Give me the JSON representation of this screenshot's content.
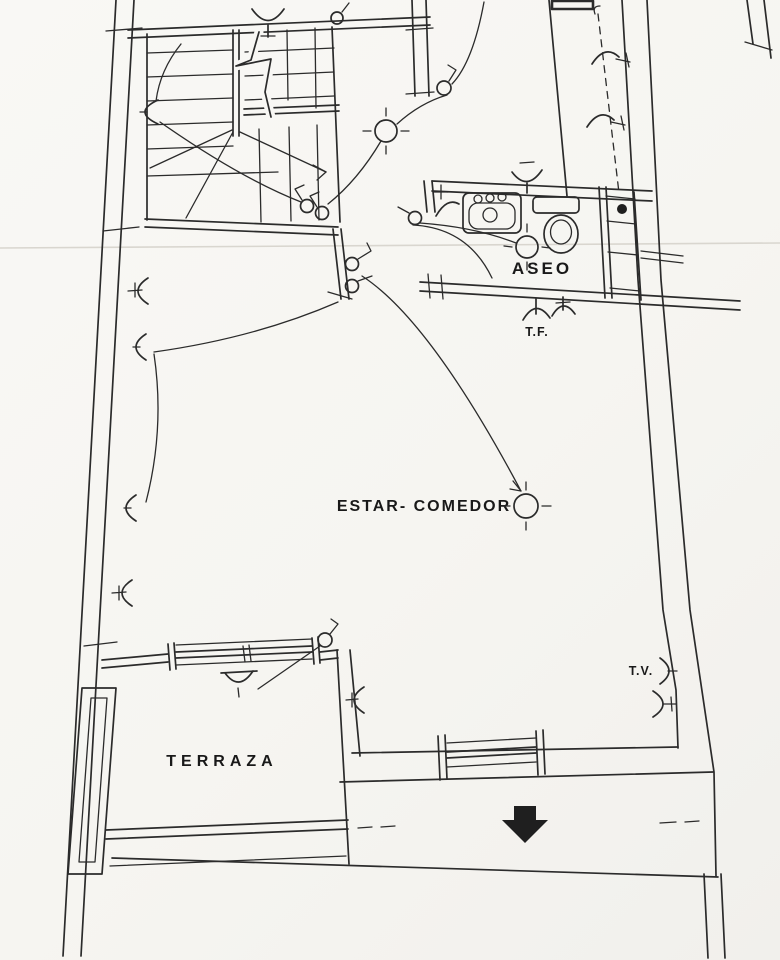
{
  "document": {
    "kind": "scanned architectural floor plan with electrical installation symbols",
    "language": "Spanish"
  },
  "labels": {
    "aseo": "ASEO",
    "estar_comedor": "ESTAR- COMEDOR",
    "terraza": "TERRAZA",
    "tf": "T.F.",
    "tv": "T.V."
  },
  "symbols": {
    "ceiling_light_icon": "circle with four radial ticks",
    "wall_light_icon": "half-circle arc on wall",
    "switch_icon": "small circle with hooked line",
    "socket_icon": "half-circle with stem (T.F. telephone, T.V. television)",
    "entrance_arrow_icon": "solid black arrow pointing down",
    "staircase": "U-shaped stair with break line and direction arrow",
    "bathroom_fixtures": [
      "sink with three taps",
      "toilet with cistern"
    ],
    "window_icon": "double-line glazing with end posts"
  },
  "counts": {
    "ceiling_lights": 3,
    "wall_lights": 10,
    "switches": 8,
    "sockets": 4,
    "windows": 2
  },
  "colors": {
    "paper": "#f8f7f4",
    "ink": "#2b2b2b",
    "scan_line": "#d9d6cf"
  }
}
